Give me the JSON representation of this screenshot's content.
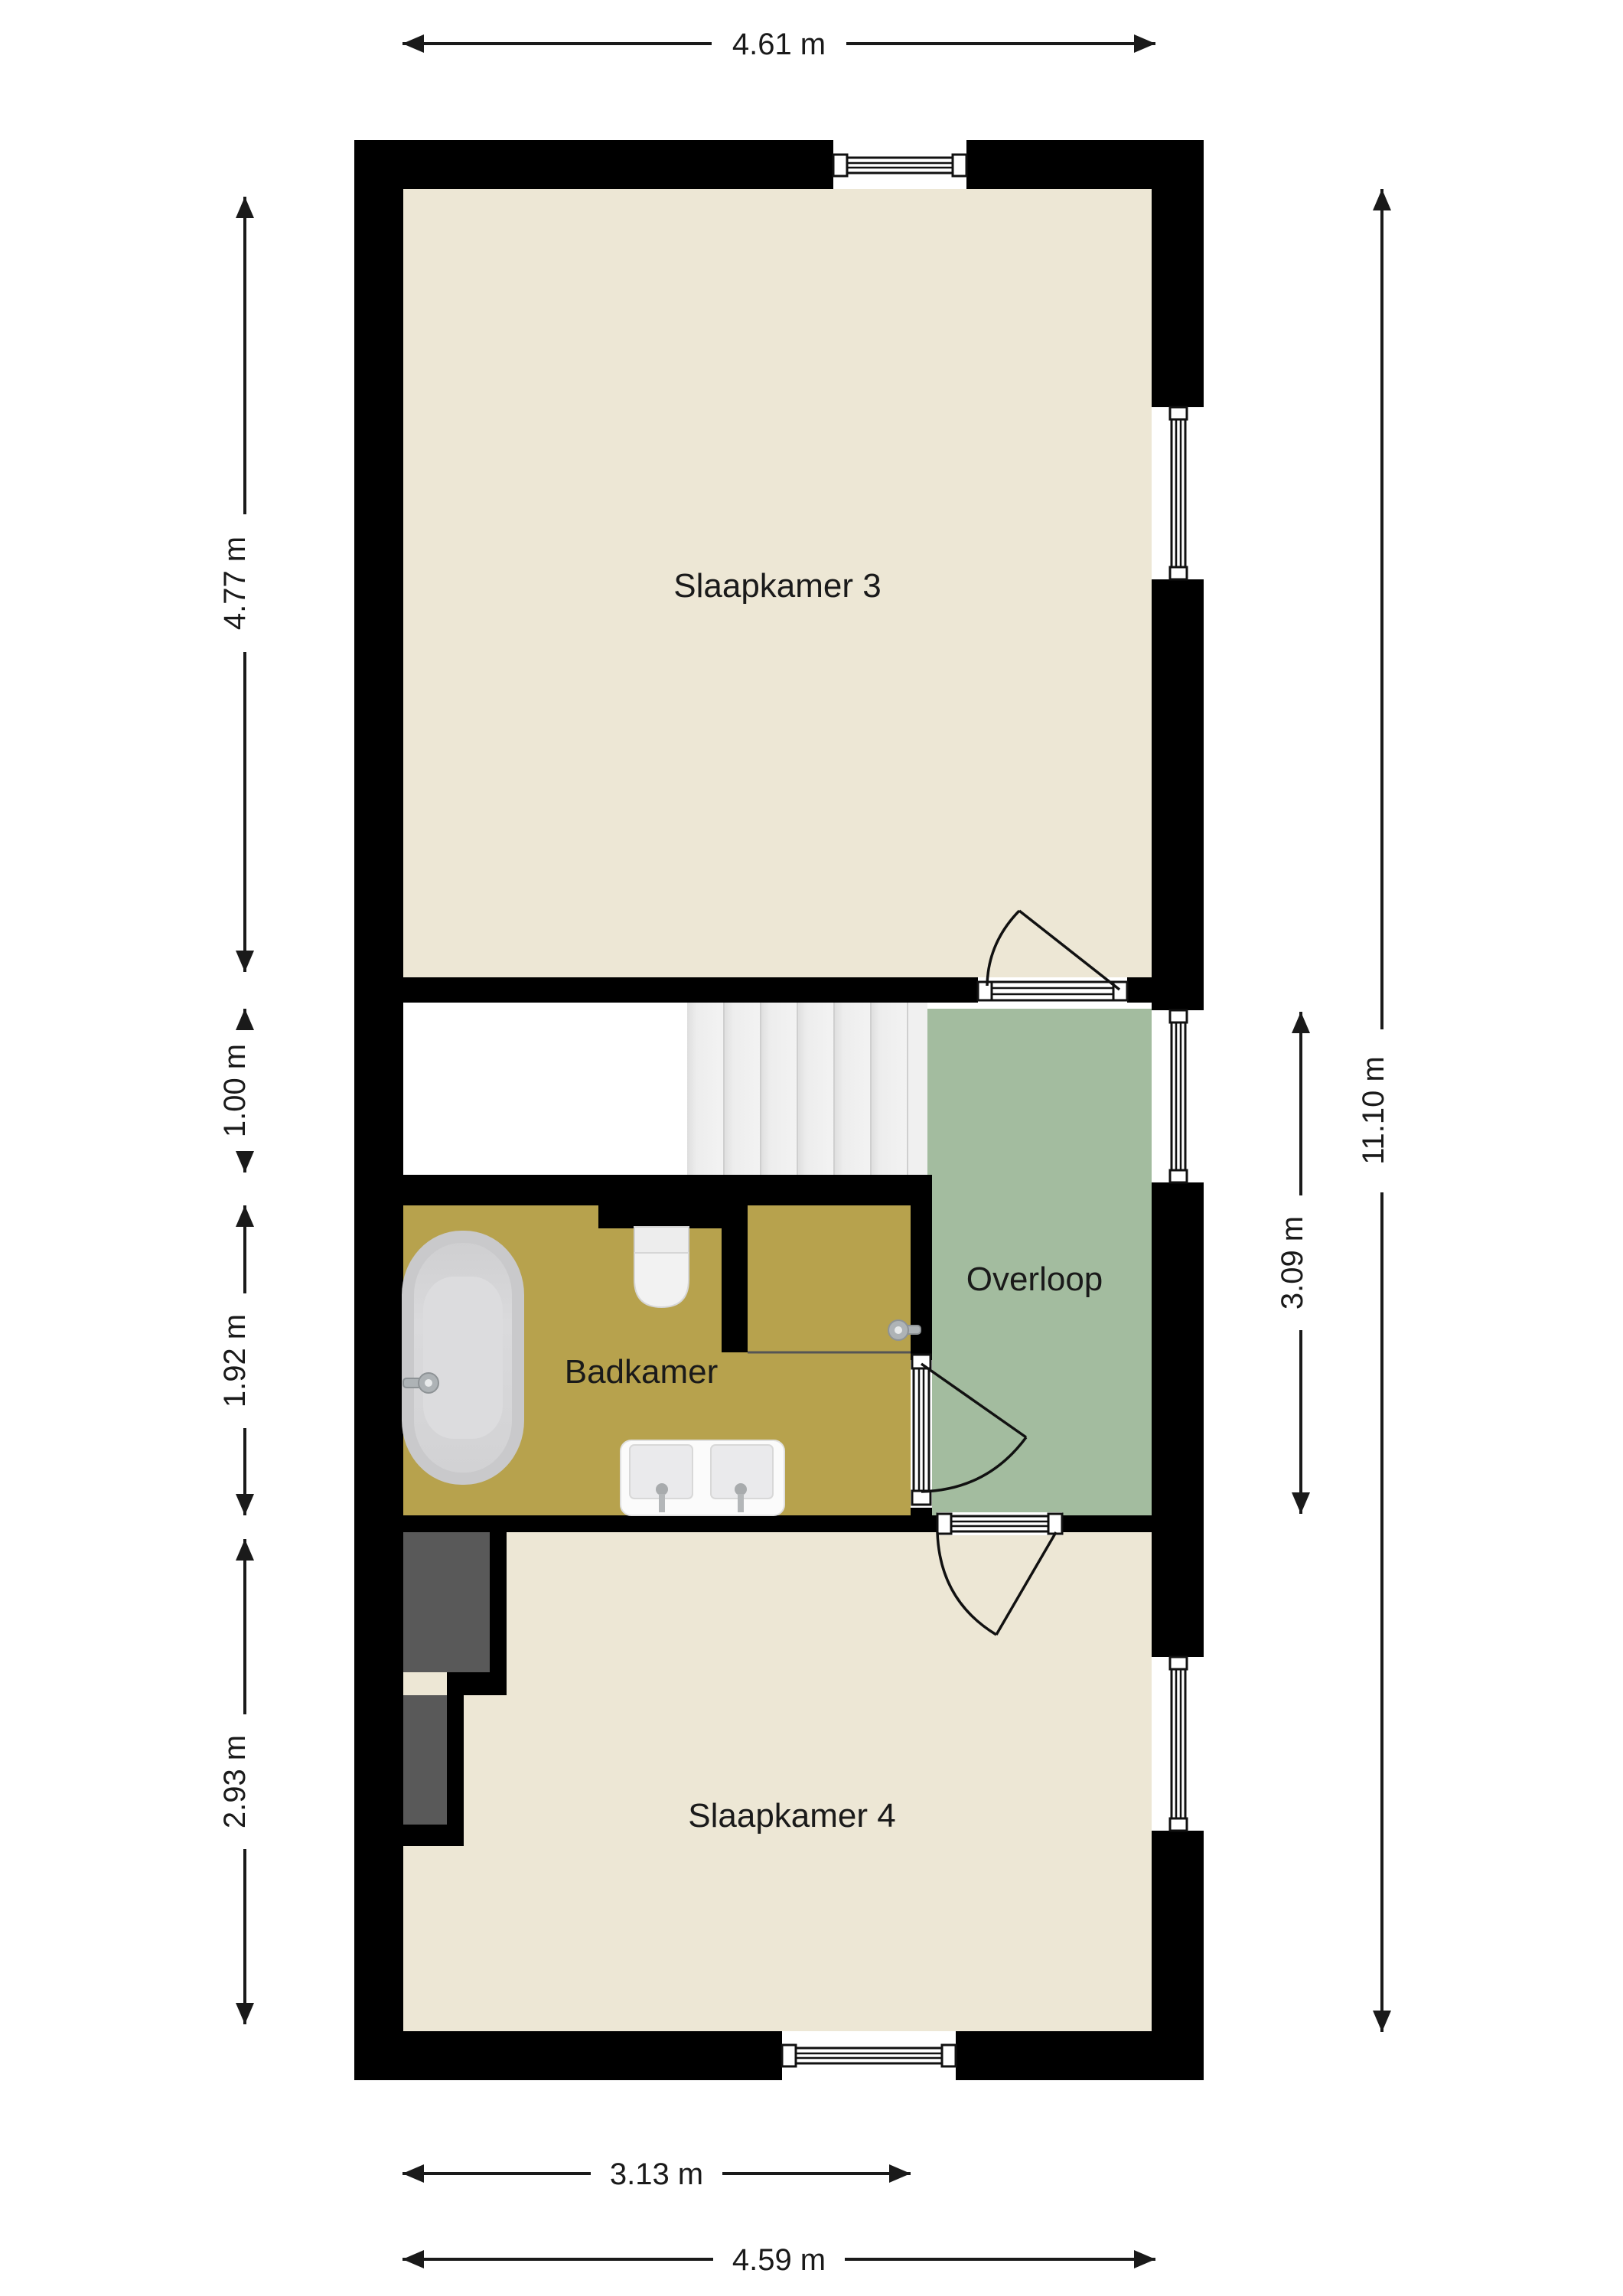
{
  "plan_title": "floor-plan-upper-storey",
  "rooms": [
    {
      "id": "slaapkamer3",
      "label": "Slaapkamer 3",
      "color": "#EDE7D5"
    },
    {
      "id": "badkamer",
      "label": "Badkamer",
      "color": "#B7A24D"
    },
    {
      "id": "overloop",
      "label": "Overloop",
      "color": "#A3BC9F"
    },
    {
      "id": "slaapkamer4",
      "label": "Slaapkamer 4",
      "color": "#EDE7D5"
    }
  ],
  "dimensions": {
    "top_width": "4.61 m",
    "left_bedroom3_height": "4.77 m",
    "left_stairhall_height": "1.00 m",
    "left_bathroom_height": "1.92 m",
    "left_bedroom4_height": "2.93 m",
    "right_landing_height": "3.09 m",
    "right_total_height": "11.10 m",
    "bottom_inner_width": "3.13 m",
    "bottom_total_width": "4.59 m"
  },
  "colors": {
    "background": "#FFFFFF",
    "wall": "#000000",
    "bedroom_floor": "#EDE7D5",
    "bathroom_floor": "#B7A24D",
    "landing_floor": "#A3BC9F",
    "stair_tread": "#EDEDED",
    "stairwell_floor": "#FFFFFF",
    "closet_void": "#595959",
    "dimension_ink": "#1A1A1A"
  },
  "fixtures": [
    "bathtub",
    "bathtub-faucet",
    "toilet",
    "double-washbasin",
    "shower-head",
    "shower-screen",
    "staircase",
    "door-bedroom3",
    "door-bathroom",
    "door-bedroom4",
    "window-top",
    "window-right-bedroom3",
    "window-right-landing",
    "window-right-bedroom4",
    "window-bottom"
  ]
}
